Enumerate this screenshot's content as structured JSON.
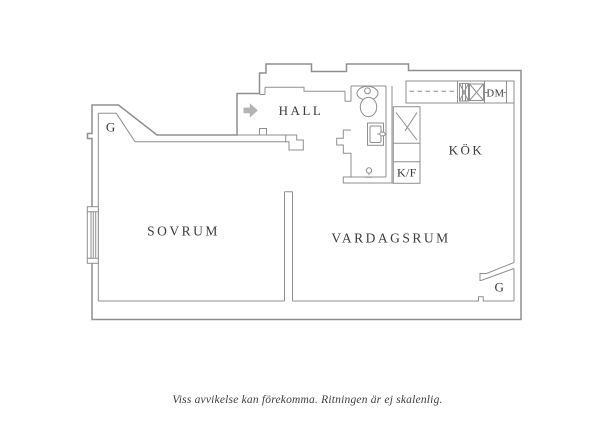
{
  "floorplan": {
    "labels": {
      "closet_top_left": "G",
      "hall": "HALL",
      "kitchen": "KÖK",
      "fridge_freezer": "K/F",
      "dishwasher": "DM",
      "bedroom": "SOVRUM",
      "living_room": "VARDAGSRUM",
      "closet_bottom_right": "G"
    },
    "caption": "Viss avvikelse kan förekomma. Ritningen är ej skalenlig.",
    "colors": {
      "wall_line": "#8f8f8f",
      "text": "#3a3a3a",
      "entry_arrow": "#b3b3b3",
      "background": "#ffffff"
    }
  }
}
